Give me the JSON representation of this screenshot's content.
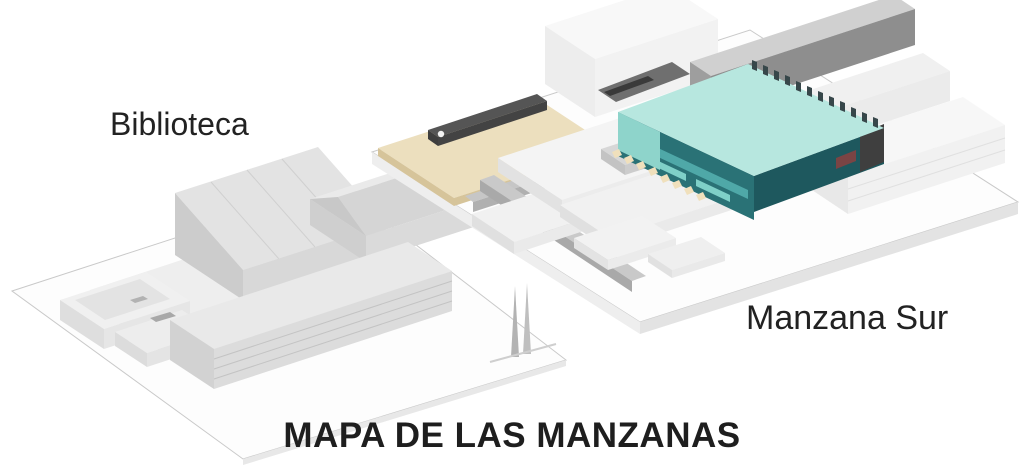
{
  "labels": {
    "biblioteca": "Biblioteca",
    "manzana_sur": "Manzana Sur",
    "title": "MAPA DE LAS MANZANAS"
  },
  "blocks": [
    {
      "id": "biblioteca",
      "label": "Biblioteca",
      "content": "library-building-model",
      "highlighted": false
    },
    {
      "id": "manzana-sur",
      "label": "Manzana Sur",
      "content": "south-block-model",
      "highlighted": true,
      "highlight_target": "teal-building"
    }
  ],
  "colors": {
    "background": "#ffffff",
    "text": "#222222",
    "platform_top": "#fdfdfd",
    "platform_edge": "#c9c9c9",
    "plaza_tan_top": "#ecdfbe",
    "plaza_tan_side": "#d6c49a",
    "bar_dark": "#555555",
    "highlight_roof_mint": "#b7e7df",
    "highlight_facade_teal": "#2a7276",
    "highlight_band_teal": "#4fa8a8",
    "highlight_end_teal": "#1e585e",
    "highlight_window_teal": "#7fd0c8",
    "accent_maroon": "#7a4444",
    "steps_cream": "#f0e0bc",
    "building_gray": "#d7d7d7"
  }
}
